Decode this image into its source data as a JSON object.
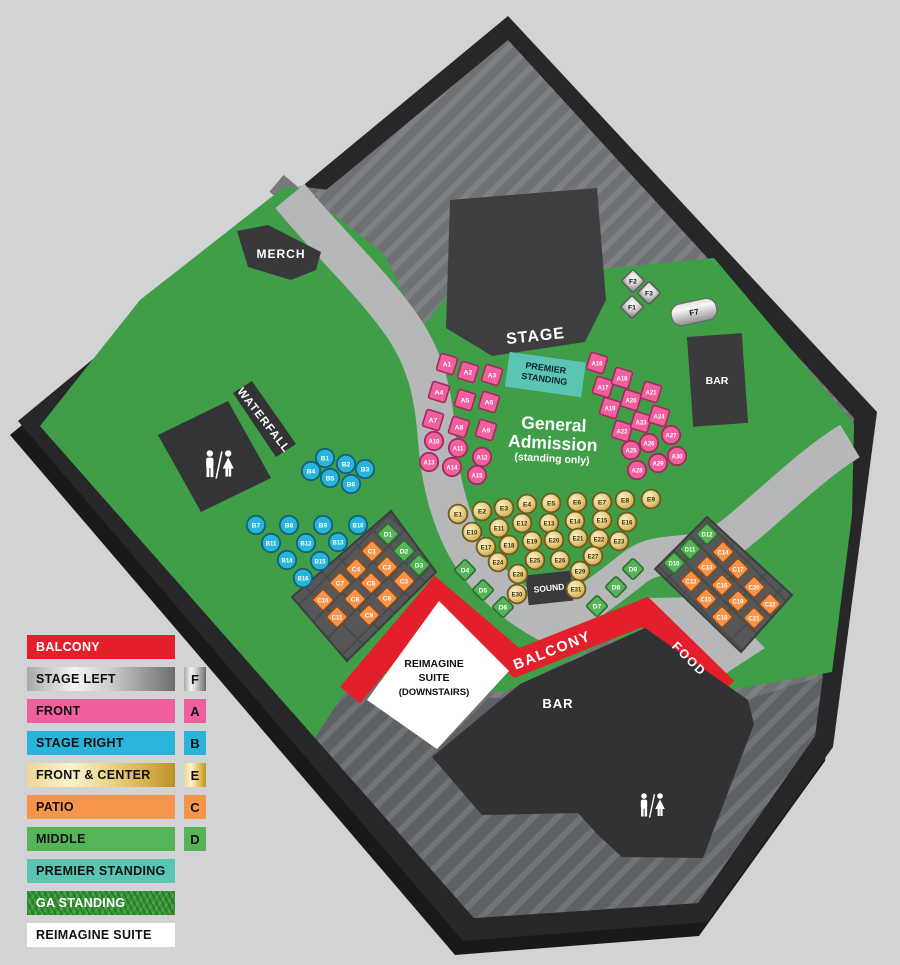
{
  "map": {
    "areas": {
      "stage": "STAGE",
      "merch": "MERCH",
      "waterfall": "WATERFALL",
      "sound": "SOUND",
      "balcony": "BALCONY",
      "food": "FOOD",
      "bar_right": "BAR",
      "bar_bottom": "BAR",
      "premier_line1": "PREMIER",
      "premier_line2": "STANDING",
      "ga_line1": "General",
      "ga_line2": "Admission",
      "ga_line3": "(standing only)",
      "suite_line1": "REIMAGINE",
      "suite_line2": "SUITE",
      "suite_line3": "(DOWNSTAIRS)",
      "f7": "F7"
    },
    "seats": {
      "columns": [
        "id",
        "x",
        "y"
      ],
      "front_squares": [
        [
          "A1",
          447,
          364
        ],
        [
          "A2",
          468,
          372
        ],
        [
          "A3",
          492,
          375
        ],
        [
          "A4",
          439,
          392
        ],
        [
          "A5",
          465,
          400
        ],
        [
          "A6",
          489,
          402
        ],
        [
          "A7",
          433,
          420
        ],
        [
          "A8",
          459,
          427
        ],
        [
          "A9",
          486,
          430
        ],
        [
          "A16",
          597,
          363
        ],
        [
          "A17",
          603,
          387
        ],
        [
          "A18",
          622,
          378
        ],
        [
          "A19",
          610,
          408
        ],
        [
          "A20",
          631,
          400
        ],
        [
          "A21",
          651,
          392
        ],
        [
          "A22",
          622,
          431
        ],
        [
          "A23",
          641,
          422
        ],
        [
          "A24",
          659,
          416
        ]
      ],
      "front_circles": [
        [
          "A10",
          434,
          441
        ],
        [
          "A11",
          458,
          448
        ],
        [
          "A12",
          482,
          457
        ],
        [
          "A13",
          429,
          462
        ],
        [
          "A14",
          452,
          467
        ],
        [
          "A15",
          477,
          475
        ],
        [
          "A25",
          631,
          450
        ],
        [
          "A26",
          649,
          443
        ],
        [
          "A27",
          671,
          435
        ],
        [
          "A28",
          637,
          470
        ],
        [
          "A29",
          658,
          463
        ],
        [
          "A30",
          677,
          456
        ]
      ],
      "stage_right": [
        [
          "B1",
          325,
          458
        ],
        [
          "B2",
          346,
          464
        ],
        [
          "B3",
          365,
          469
        ],
        [
          "B4",
          311,
          471
        ],
        [
          "B5",
          330,
          478
        ],
        [
          "B6",
          351,
          484
        ],
        [
          "B7",
          256,
          525
        ],
        [
          "B8",
          289,
          525
        ],
        [
          "B9",
          323,
          525
        ],
        [
          "B10",
          358,
          525
        ],
        [
          "B11",
          271,
          543
        ],
        [
          "B12",
          306,
          543
        ],
        [
          "B13",
          338,
          542
        ],
        [
          "B14",
          287,
          560
        ],
        [
          "B15",
          320,
          561
        ],
        [
          "B16",
          303,
          578
        ]
      ],
      "front_center": [
        [
          "E1",
          458,
          514
        ],
        [
          "E2",
          482,
          511
        ],
        [
          "E3",
          504,
          508
        ],
        [
          "E4",
          527,
          504
        ],
        [
          "E5",
          551,
          503
        ],
        [
          "E6",
          577,
          502
        ],
        [
          "E7",
          602,
          502
        ],
        [
          "E8",
          625,
          500
        ],
        [
          "E9",
          651,
          499
        ],
        [
          "E10",
          472,
          532
        ],
        [
          "E11",
          499,
          528
        ],
        [
          "E12",
          522,
          523
        ],
        [
          "E13",
          549,
          523
        ],
        [
          "E14",
          575,
          521
        ],
        [
          "E15",
          602,
          520
        ],
        [
          "E16",
          627,
          522
        ],
        [
          "E17",
          486,
          547
        ],
        [
          "E18",
          509,
          545
        ],
        [
          "E19",
          532,
          541
        ],
        [
          "E20",
          554,
          540
        ],
        [
          "E21",
          578,
          538
        ],
        [
          "E22",
          599,
          539
        ],
        [
          "E23",
          619,
          541
        ],
        [
          "E24",
          498,
          562
        ],
        [
          "E25",
          535,
          560
        ],
        [
          "E26",
          560,
          560
        ],
        [
          "E27",
          593,
          556
        ],
        [
          "E28",
          518,
          574
        ],
        [
          "E29",
          580,
          571
        ],
        [
          "E30",
          517,
          594
        ],
        [
          "E31",
          576,
          589
        ]
      ],
      "patio": [
        [
          "C1",
          372,
          551
        ],
        [
          "C2",
          387,
          567
        ],
        [
          "C3",
          404,
          581
        ],
        [
          "C4",
          356,
          569
        ],
        [
          "C5",
          371,
          583
        ],
        [
          "C6",
          387,
          598
        ],
        [
          "C7",
          340,
          583
        ],
        [
          "C8",
          355,
          599
        ],
        [
          "C9",
          369,
          615
        ],
        [
          "C10",
          323,
          600
        ],
        [
          "C11",
          337,
          617
        ],
        [
          "C12",
          691,
          581
        ],
        [
          "C13",
          707,
          567
        ],
        [
          "C14",
          723,
          552
        ],
        [
          "C15",
          706,
          599
        ],
        [
          "C16",
          722,
          585
        ],
        [
          "C17",
          738,
          569
        ],
        [
          "C18",
          722,
          617
        ],
        [
          "C19",
          738,
          601
        ],
        [
          "C20",
          754,
          587
        ],
        [
          "C21",
          754,
          618
        ],
        [
          "C22",
          770,
          604
        ]
      ],
      "middle": [
        [
          "D1",
          388,
          534
        ],
        [
          "D2",
          404,
          551
        ],
        [
          "D3",
          419,
          565
        ],
        [
          "D4",
          465,
          570
        ],
        [
          "D5",
          483,
          590
        ],
        [
          "D6",
          503,
          607
        ],
        [
          "D7",
          597,
          606
        ],
        [
          "D8",
          616,
          587
        ],
        [
          "D9",
          633,
          569
        ],
        [
          "D10",
          674,
          563
        ],
        [
          "D11",
          690,
          549
        ],
        [
          "D12",
          707,
          534
        ]
      ],
      "stage_left": [
        [
          "F1",
          632,
          307
        ],
        [
          "F2",
          633,
          281
        ],
        [
          "F3",
          649,
          293
        ]
      ]
    }
  },
  "legend": {
    "items": [
      {
        "label": "BALCONY",
        "style": "red",
        "badge": null,
        "white_text": true
      },
      {
        "label": "STAGE LEFT",
        "style": "silver",
        "badge": "F",
        "badge_style": "silver",
        "white_text": false
      },
      {
        "label": "FRONT",
        "style": "pink",
        "badge": "A",
        "badge_style": "pink",
        "white_text": false
      },
      {
        "label": "STAGE RIGHT",
        "style": "cyan",
        "badge": "B",
        "badge_style": "cyan",
        "white_text": false
      },
      {
        "label": "FRONT & CENTER",
        "style": "gold",
        "badge": "E",
        "badge_style": "gold",
        "white_text": false
      },
      {
        "label": "PATIO",
        "style": "orange",
        "badge": "C",
        "badge_style": "orange",
        "white_text": false
      },
      {
        "label": "MIDDLE",
        "style": "green",
        "badge": "D",
        "badge_style": "green",
        "white_text": false
      },
      {
        "label": "PREMIER STANDING",
        "style": "teal",
        "badge": null,
        "white_text": false
      },
      {
        "label": "GA STANDING",
        "style": "grass",
        "badge": null,
        "white_text": true
      },
      {
        "label": "REIMAGINE SUITE",
        "style": "white",
        "badge": null,
        "white_text": false
      }
    ]
  },
  "colors": {
    "balcony_red": "#e31f2b",
    "front_pink": "#f0609e",
    "stage_right_cyan": "#29b5da",
    "front_center_gold": "#dfc276",
    "patio_orange": "#f5944a",
    "middle_green": "#55b457",
    "premier_teal": "#5ac5b2",
    "ga_green": "#3f9f41",
    "stage_left_silver": "#c8c8c8",
    "suite_white": "#ffffff"
  }
}
